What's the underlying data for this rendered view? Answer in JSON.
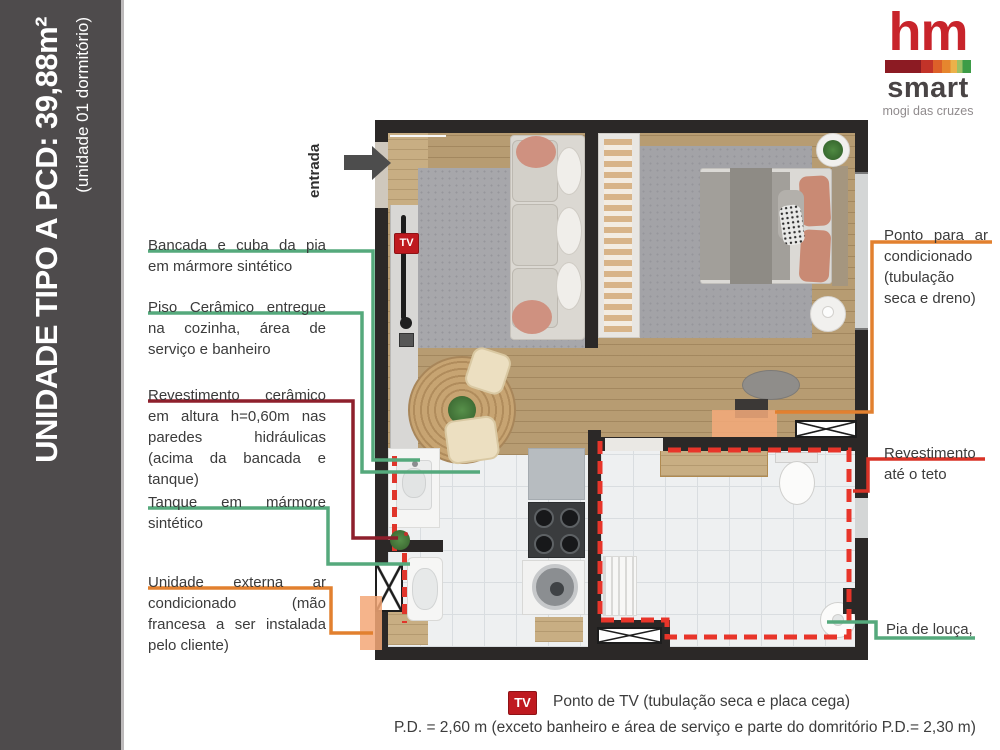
{
  "sidebar": {
    "title": "UNIDADE TIPO A PCD: 39,88m²",
    "subtitle": "(unidade 01 dormitório)"
  },
  "logo": {
    "name": "hm",
    "product": "smart",
    "tagline": "mogi das cruzes"
  },
  "plan": {
    "entrance_label": "entrada",
    "tv_badge": "TV"
  },
  "annotations": {
    "left": [
      {
        "text": "Bancada e cuba da pia em mármore sintético",
        "color": "#55a97c"
      },
      {
        "text": "Piso Cerâmico entregue na cozinha, área de serviço e banheiro",
        "color": "#55a97c"
      },
      {
        "text": "Revestimento cerâmico em altura h=0,60m nas paredes hidráulicas (acima da bancada e tanque)",
        "color": "#8e1f2c"
      },
      {
        "text": "Tanque em mármore sintético",
        "color": "#55a97c"
      },
      {
        "text": "Unidade externa ar condicionado (mão francesa a ser instalada pelo cliente)",
        "color": "#e2802f"
      }
    ],
    "right": [
      {
        "text": "Ponto para ar condicionado (tubulação seca e dreno)",
        "color": "#e2802f"
      },
      {
        "text": "Revestimento até o teto",
        "color": "#d93226"
      },
      {
        "text": "Pia de louça,",
        "color": "#55a97c"
      }
    ]
  },
  "legend": {
    "tv_badge": "TV",
    "tv_note": "Ponto de TV (tubulação seca e placa cega)",
    "pd_note": "P.D. = 2,60 m (exceto banheiro e área de serviço e parte do domritório P.D.= 2,30 m)"
  },
  "colors": {
    "sidebar": "#4e4b4c",
    "wall": "#2b2827",
    "leader_green": "#55a97c",
    "leader_dark_red": "#8e1f2c",
    "leader_red": "#d93226",
    "leader_orange": "#e2802f",
    "highlight_salmon": "#f3a777",
    "tv_red": "#bf1a20",
    "logo_red": "#c8242b"
  }
}
